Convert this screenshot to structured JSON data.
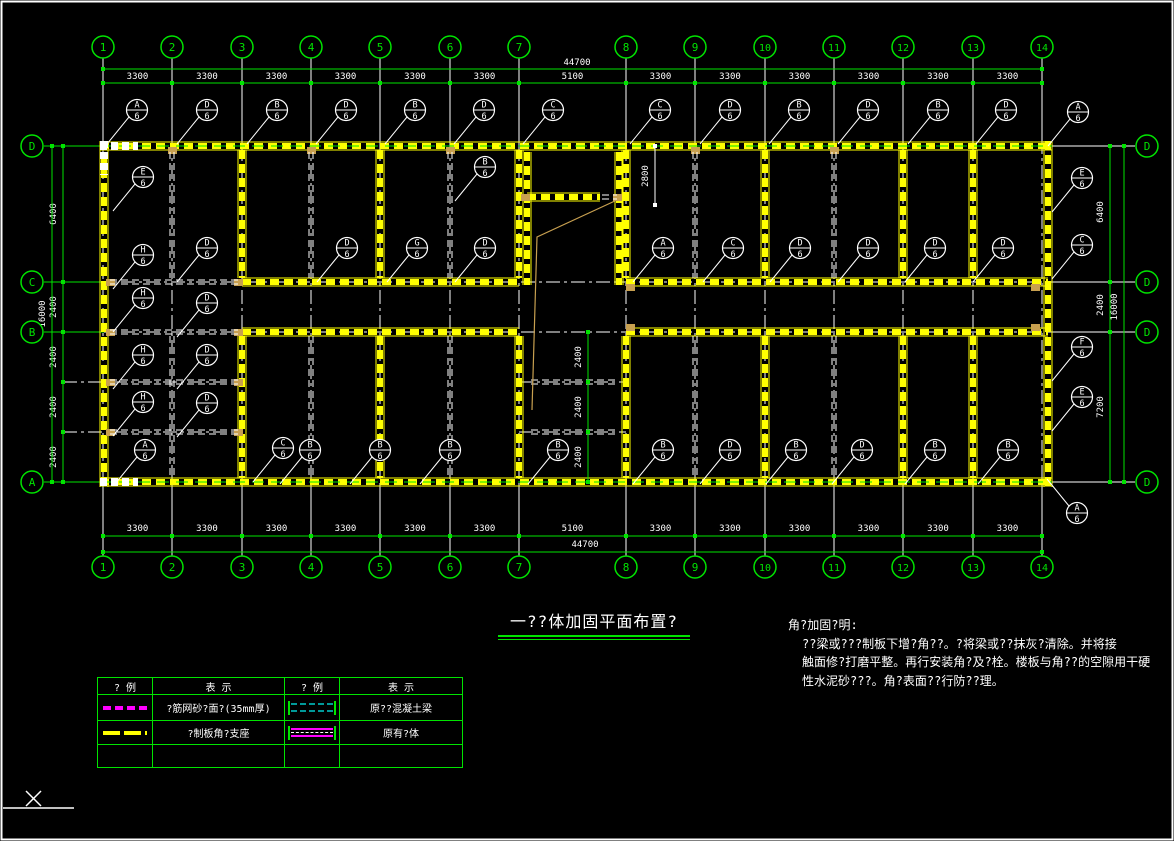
{
  "window": {
    "app": "cad-model-space"
  },
  "title_block": {
    "title": "一??体加固平面布置?"
  },
  "notes": {
    "title": "角?加固?明:",
    "lines": [
      "??梁或???制板下增?角??。?将梁或??抹灰?清除。并将接",
      "触面修?打磨平整。再行安装角?及?栓。楼板与角??的空隙用干硬",
      "性水泥砂???。角?表面??行防??理。"
    ]
  },
  "legend": {
    "headers": [
      "? 例",
      "表   示",
      "? 例",
      "表   示"
    ],
    "rows": [
      {
        "symbol": "steel-mesh-mortar-line",
        "label": "?筋网砂?面?(35mm厚)",
        "symbol2": "existing-concrete-beam",
        "label2": "原??混凝土梁"
      },
      {
        "symbol": "precast-slab-angle-support",
        "label": "?制板角?支座",
        "symbol2": "existing-wall",
        "label2": "原有?体"
      }
    ]
  },
  "plan": {
    "colors": {
      "green": "#00e400",
      "yellow": "#ffff00",
      "white": "#ffffff",
      "tan": "#c8a050"
    },
    "axes": {
      "columns": [
        {
          "label": "1",
          "x": 103
        },
        {
          "label": "2",
          "x": 172
        },
        {
          "label": "3",
          "x": 242
        },
        {
          "label": "4",
          "x": 311
        },
        {
          "label": "5",
          "x": 380
        },
        {
          "label": "6",
          "x": 450
        },
        {
          "label": "7",
          "x": 519
        },
        {
          "label": "8",
          "x": 626
        },
        {
          "label": "9",
          "x": 695
        },
        {
          "label": "10",
          "x": 765
        },
        {
          "label": "11",
          "x": 834
        },
        {
          "label": "12",
          "x": 903
        },
        {
          "label": "13",
          "x": 973
        },
        {
          "label": "14",
          "x": 1042
        }
      ],
      "rows_left": [
        {
          "label": "D",
          "y": 146
        },
        {
          "label": "C",
          "y": 282
        },
        {
          "label": "B",
          "y": 332
        },
        {
          "label": "A",
          "y": 482
        }
      ],
      "rows_right": [
        {
          "label": "D",
          "y": 146
        },
        {
          "label": "D",
          "y": 282
        },
        {
          "label": "D",
          "y": 332
        },
        {
          "label": "D",
          "y": 482
        }
      ],
      "aux_rows": [
        382,
        432
      ]
    },
    "walls": [
      [
        100,
        146,
        1052,
        146
      ],
      [
        100,
        482,
        1052,
        482
      ],
      [
        104,
        141,
        104,
        487
      ],
      [
        1048,
        141,
        1048,
        487
      ],
      [
        242,
        282,
        519,
        282
      ],
      [
        626,
        282,
        1048,
        282
      ],
      [
        242,
        332,
        519,
        332
      ],
      [
        626,
        332,
        1048,
        332
      ],
      [
        242,
        150,
        242,
        278
      ],
      [
        380,
        150,
        380,
        278
      ],
      [
        519,
        150,
        519,
        278
      ],
      [
        626,
        150,
        626,
        278
      ],
      [
        765,
        150,
        765,
        278
      ],
      [
        903,
        150,
        903,
        278
      ],
      [
        973,
        150,
        973,
        278
      ],
      [
        527,
        152,
        527,
        285
      ],
      [
        619,
        152,
        619,
        285
      ],
      [
        527,
        197,
        600,
        197
      ],
      [
        242,
        336,
        242,
        478
      ],
      [
        380,
        336,
        380,
        478
      ],
      [
        519,
        336,
        519,
        478
      ],
      [
        626,
        336,
        626,
        478
      ],
      [
        765,
        336,
        765,
        478
      ],
      [
        903,
        336,
        903,
        478
      ],
      [
        973,
        336,
        973,
        478
      ]
    ],
    "beams": [
      [
        110,
        282,
        238,
        282
      ],
      [
        110,
        332,
        238,
        332
      ],
      [
        110,
        382,
        238,
        382
      ],
      [
        110,
        432,
        238,
        432
      ],
      [
        531,
        382,
        615,
        382
      ],
      [
        531,
        432,
        615,
        432
      ],
      [
        602,
        197,
        617,
        197
      ],
      [
        172,
        152,
        172,
        278
      ],
      [
        172,
        336,
        172,
        478
      ],
      [
        311,
        152,
        311,
        278
      ],
      [
        311,
        336,
        311,
        478
      ],
      [
        450,
        152,
        450,
        278
      ],
      [
        450,
        336,
        450,
        478
      ],
      [
        695,
        152,
        695,
        278
      ],
      [
        695,
        336,
        695,
        478
      ],
      [
        834,
        152,
        834,
        278
      ],
      [
        834,
        336,
        834,
        478
      ]
    ],
    "openings": [
      [
        100,
        146,
        138,
        146
      ],
      [
        104,
        141,
        104,
        175
      ],
      [
        100,
        482,
        138,
        482
      ]
    ],
    "pockets": [
      [
        110,
        282
      ],
      [
        238,
        282
      ],
      [
        110,
        332
      ],
      [
        238,
        332
      ],
      [
        110,
        382
      ],
      [
        238,
        382
      ],
      [
        110,
        432
      ],
      [
        238,
        432
      ],
      [
        525,
        197
      ],
      [
        617,
        197
      ],
      [
        630,
        287
      ],
      [
        630,
        327
      ],
      [
        1035,
        287
      ],
      [
        1035,
        327
      ],
      [
        172,
        150
      ],
      [
        311,
        150
      ],
      [
        450,
        150
      ],
      [
        695,
        150
      ],
      [
        834,
        150
      ]
    ],
    "stair": {
      "points": "617,200 537,237 532,410"
    },
    "dims": {
      "top": {
        "line1_y": 69,
        "line2_y": 83,
        "total": "44700",
        "total_x": 577,
        "segments": [
          "3300",
          "3300",
          "3300",
          "3300",
          "3300",
          "3300",
          "5100",
          "3300",
          "3300",
          "3300",
          "3300",
          "3300",
          "3300"
        ]
      },
      "bottom": {
        "line1_y": 536,
        "line2_y": 552,
        "total": "44700",
        "total_x": 585,
        "segments": [
          "3300",
          "3300",
          "3300",
          "3300",
          "3300",
          "3300",
          "5100",
          "3300",
          "3300",
          "3300",
          "3300",
          "3300",
          "3300"
        ]
      },
      "left": {
        "line1_x": 63,
        "line2_x": 52,
        "total": "16000",
        "total_y": 314,
        "ticks": [
          146,
          282,
          332,
          382,
          432,
          482
        ],
        "labels": [
          [
            "6400",
            214
          ],
          [
            "2400",
            307
          ],
          [
            "2400",
            357
          ],
          [
            "2400",
            407
          ],
          [
            "2400",
            457
          ]
        ]
      },
      "right": {
        "line1_x": 1110,
        "line2_x": 1124,
        "total": "16000",
        "total_y": 307,
        "ticks": [
          146,
          282,
          332,
          482
        ],
        "labels": [
          [
            "6400",
            212
          ],
          [
            "2400",
            305
          ],
          [
            "7200",
            407
          ]
        ]
      },
      "interior": {
        "x": 588,
        "ticks": [
          332,
          382,
          432,
          482
        ],
        "labels": [
          [
            "2400",
            357
          ],
          [
            "2400",
            407
          ],
          [
            "2400",
            457
          ]
        ]
      },
      "stair": {
        "x": 655,
        "y1": 146,
        "y2": 205,
        "label": "2800",
        "label_y": 176
      }
    },
    "callouts": [
      {
        "l": "A",
        "x": 137,
        "y": 110
      },
      {
        "l": "D",
        "x": 207,
        "y": 110
      },
      {
        "l": "B",
        "x": 277,
        "y": 110
      },
      {
        "l": "D",
        "x": 346,
        "y": 110
      },
      {
        "l": "B",
        "x": 415,
        "y": 110
      },
      {
        "l": "D",
        "x": 484,
        "y": 110
      },
      {
        "l": "C",
        "x": 553,
        "y": 110
      },
      {
        "l": "C",
        "x": 660,
        "y": 110
      },
      {
        "l": "D",
        "x": 730,
        "y": 110
      },
      {
        "l": "B",
        "x": 799,
        "y": 110
      },
      {
        "l": "D",
        "x": 868,
        "y": 110
      },
      {
        "l": "B",
        "x": 938,
        "y": 110
      },
      {
        "l": "D",
        "x": 1006,
        "y": 110
      },
      {
        "l": "A",
        "x": 1078,
        "y": 112
      },
      {
        "l": "E",
        "x": 143,
        "y": 177
      },
      {
        "l": "H",
        "x": 143,
        "y": 255
      },
      {
        "l": "D",
        "x": 207,
        "y": 248
      },
      {
        "l": "H",
        "x": 143,
        "y": 298
      },
      {
        "l": "D",
        "x": 207,
        "y": 303
      },
      {
        "l": "H",
        "x": 143,
        "y": 355
      },
      {
        "l": "D",
        "x": 207,
        "y": 355
      },
      {
        "l": "H",
        "x": 143,
        "y": 402
      },
      {
        "l": "D",
        "x": 207,
        "y": 403
      },
      {
        "l": "A",
        "x": 145,
        "y": 450
      },
      {
        "l": "C",
        "x": 283,
        "y": 448
      },
      {
        "l": "D",
        "x": 347,
        "y": 248
      },
      {
        "l": "G",
        "x": 417,
        "y": 248
      },
      {
        "l": "B",
        "x": 485,
        "y": 167
      },
      {
        "l": "D",
        "x": 485,
        "y": 248
      },
      {
        "l": "A",
        "x": 663,
        "y": 248
      },
      {
        "l": "C",
        "x": 733,
        "y": 248
      },
      {
        "l": "D",
        "x": 800,
        "y": 248
      },
      {
        "l": "D",
        "x": 868,
        "y": 248
      },
      {
        "l": "D",
        "x": 935,
        "y": 248
      },
      {
        "l": "D",
        "x": 1003,
        "y": 248
      },
      {
        "l": "B",
        "x": 310,
        "y": 450
      },
      {
        "l": "B",
        "x": 380,
        "y": 450
      },
      {
        "l": "B",
        "x": 450,
        "y": 450
      },
      {
        "l": "B",
        "x": 558,
        "y": 450
      },
      {
        "l": "B",
        "x": 663,
        "y": 450
      },
      {
        "l": "D",
        "x": 730,
        "y": 450
      },
      {
        "l": "B",
        "x": 796,
        "y": 450
      },
      {
        "l": "D",
        "x": 862,
        "y": 450
      },
      {
        "l": "B",
        "x": 935,
        "y": 450
      },
      {
        "l": "B",
        "x": 1008,
        "y": 450
      },
      {
        "l": "E",
        "x": 1082,
        "y": 178
      },
      {
        "l": "C",
        "x": 1082,
        "y": 245
      },
      {
        "l": "F",
        "x": 1082,
        "y": 347
      },
      {
        "l": "E",
        "x": 1082,
        "y": 397
      },
      {
        "l": "A",
        "x": 1077,
        "y": 513,
        "d": "ul"
      }
    ],
    "callout_sheet_number": "6"
  }
}
